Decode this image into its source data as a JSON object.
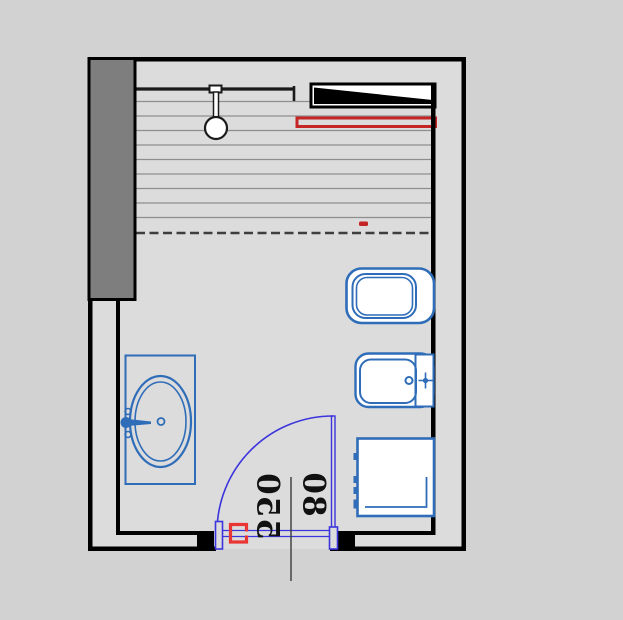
{
  "page": {
    "title": "Bathroom floor plan"
  },
  "labels": {
    "dim_550": "550",
    "dim_80": "80"
  },
  "colors": {
    "outside_background": "#d2d2d2",
    "floor": "#dcdcdc",
    "wall": "#000000",
    "pillar_fill": "#7e7e7e",
    "fixture_blue": "#2f6db8",
    "door_blue": "#3c34dc",
    "red_dark": "#c52525",
    "red_bright": "#ea3535",
    "hatch_line": "#8e8e8e",
    "partition_line": "#1a1a1a",
    "dashed_line": "#3e3e3e",
    "dim_line": "#3a3a3a",
    "dim_text": "#111111"
  },
  "symbols": {
    "shower_area": "hatched-shower-floor",
    "shower_head": "shower-head-symbol",
    "shelf": "wall-shelf-symbol",
    "radiator": "red-radiator-symbol",
    "toilet": "toilet-symbol",
    "bidet": "bidet-symbol",
    "washing_machine": "washing-machine-symbol",
    "sink": "sink-with-basin-symbol",
    "door": "door-swing-symbol",
    "section_marker": "red-section-bracket"
  }
}
